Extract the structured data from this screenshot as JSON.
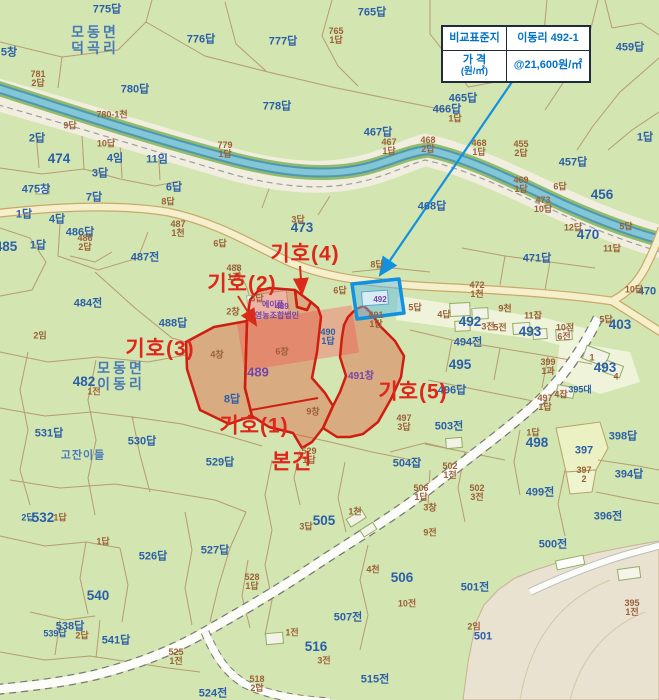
{
  "info_box": {
    "row1_label": "비교표준지",
    "row1_value": "이동리 492-1",
    "row2_label": "가 격",
    "row2_label_sub": "(원/㎡)",
    "row2_value": "@21,600원/㎡"
  },
  "annotations": [
    {
      "t": "기호(4)",
      "x": 305,
      "y": 254
    },
    {
      "t": "기호(2)",
      "x": 242,
      "y": 284
    },
    {
      "t": "기호(3)",
      "x": 160,
      "y": 349
    },
    {
      "t": "기호(1)",
      "x": 254,
      "y": 426
    },
    {
      "t": "기호(5)",
      "x": 413,
      "y": 392
    },
    {
      "t": "본건",
      "x": 292,
      "y": 462
    }
  ],
  "labels": [
    {
      "t": "모동면\n덕곡리",
      "x": 95,
      "y": 40,
      "c": "pl"
    },
    {
      "t": "모동면\n이동리",
      "x": 121,
      "y": 376,
      "c": "pl"
    },
    {
      "t": "고잔이들",
      "x": 83,
      "y": 456,
      "c": "pl",
      "s": "sm"
    },
    {
      "t": "775답",
      "x": 107,
      "y": 10,
      "c": "b"
    },
    {
      "t": "776답",
      "x": 201,
      "y": 40,
      "c": "b"
    },
    {
      "t": "777답",
      "x": 283,
      "y": 42,
      "c": "b"
    },
    {
      "t": "765답",
      "x": 372,
      "y": 13,
      "c": "b"
    },
    {
      "t": "780답",
      "x": 135,
      "y": 90,
      "c": "b"
    },
    {
      "t": "778답",
      "x": 277,
      "y": 107,
      "c": "b"
    },
    {
      "t": "467답",
      "x": 378,
      "y": 133,
      "c": "b"
    },
    {
      "t": "459답",
      "x": 630,
      "y": 48,
      "c": "b"
    },
    {
      "t": "465답",
      "x": 463,
      "y": 99,
      "c": "b"
    },
    {
      "t": "466답",
      "x": 447,
      "y": 110,
      "c": "b"
    },
    {
      "t": "474",
      "x": 59,
      "y": 159,
      "c": "b",
      "s": "lg"
    },
    {
      "t": "2답",
      "x": 37,
      "y": 139,
      "c": "b"
    },
    {
      "t": "4임",
      "x": 115,
      "y": 159,
      "c": "b"
    },
    {
      "t": "11임",
      "x": 157,
      "y": 160,
      "c": "b"
    },
    {
      "t": "3답",
      "x": 100,
      "y": 174,
      "c": "b"
    },
    {
      "t": "5창",
      "x": 9,
      "y": 53,
      "c": "b"
    },
    {
      "t": "475창",
      "x": 36,
      "y": 190,
      "c": "b"
    },
    {
      "t": "6답",
      "x": 174,
      "y": 188,
      "c": "b"
    },
    {
      "t": "7답",
      "x": 94,
      "y": 198,
      "c": "b"
    },
    {
      "t": "1답",
      "x": 24,
      "y": 215,
      "c": "b"
    },
    {
      "t": "4답",
      "x": 57,
      "y": 220,
      "c": "b"
    },
    {
      "t": "486답",
      "x": 80,
      "y": 233,
      "c": "b"
    },
    {
      "t": "485",
      "x": 6,
      "y": 247,
      "c": "b",
      "s": "lg"
    },
    {
      "t": "1답",
      "x": 38,
      "y": 246,
      "c": "b"
    },
    {
      "t": "487전",
      "x": 145,
      "y": 258,
      "c": "b"
    },
    {
      "t": "473",
      "x": 302,
      "y": 228,
      "c": "b",
      "s": "lg"
    },
    {
      "t": "484전",
      "x": 88,
      "y": 304,
      "c": "b"
    },
    {
      "t": "488답",
      "x": 173,
      "y": 324,
      "c": "b"
    },
    {
      "t": "482",
      "x": 84,
      "y": 382,
      "c": "b",
      "s": "lg"
    },
    {
      "t": "531답",
      "x": 49,
      "y": 434,
      "c": "b"
    },
    {
      "t": "530답",
      "x": 142,
      "y": 442,
      "c": "b"
    },
    {
      "t": "529답",
      "x": 220,
      "y": 463,
      "c": "b"
    },
    {
      "t": "8답",
      "x": 232,
      "y": 400,
      "c": "b"
    },
    {
      "t": "527답",
      "x": 215,
      "y": 551,
      "c": "b"
    },
    {
      "t": "526답",
      "x": 153,
      "y": 557,
      "c": "b"
    },
    {
      "t": "532",
      "x": 43,
      "y": 518,
      "c": "b",
      "s": "lg"
    },
    {
      "t": "2답",
      "x": 28,
      "y": 518,
      "c": "b",
      "s": "sm"
    },
    {
      "t": "540",
      "x": 98,
      "y": 596,
      "c": "b",
      "s": "lg"
    },
    {
      "t": "538답",
      "x": 70,
      "y": 627,
      "c": "b"
    },
    {
      "t": "539답",
      "x": 55,
      "y": 634,
      "c": "b",
      "s": "sm"
    },
    {
      "t": "541답",
      "x": 116,
      "y": 641,
      "c": "b"
    },
    {
      "t": "524전",
      "x": 213,
      "y": 694,
      "c": "b"
    },
    {
      "t": "516",
      "x": 316,
      "y": 647,
      "c": "b",
      "s": "lg"
    },
    {
      "t": "515전",
      "x": 375,
      "y": 680,
      "c": "b"
    },
    {
      "t": "507전",
      "x": 348,
      "y": 618,
      "c": "b"
    },
    {
      "t": "505",
      "x": 324,
      "y": 521,
      "c": "b",
      "s": "lg"
    },
    {
      "t": "506",
      "x": 402,
      "y": 578,
      "c": "b",
      "s": "lg"
    },
    {
      "t": "501전",
      "x": 475,
      "y": 588,
      "c": "b"
    },
    {
      "t": "501",
      "x": 483,
      "y": 637,
      "c": "b"
    },
    {
      "t": "500전",
      "x": 553,
      "y": 545,
      "c": "b"
    },
    {
      "t": "499전",
      "x": 540,
      "y": 493,
      "c": "b"
    },
    {
      "t": "396전",
      "x": 608,
      "y": 517,
      "c": "b"
    },
    {
      "t": "398답",
      "x": 623,
      "y": 437,
      "c": "b"
    },
    {
      "t": "394답",
      "x": 629,
      "y": 475,
      "c": "b"
    },
    {
      "t": "397",
      "x": 584,
      "y": 451,
      "c": "b"
    },
    {
      "t": "498",
      "x": 537,
      "y": 443,
      "c": "b",
      "s": "lg"
    },
    {
      "t": "1답",
      "x": 533,
      "y": 433,
      "c": "br"
    },
    {
      "t": "496답",
      "x": 452,
      "y": 391,
      "c": "b"
    },
    {
      "t": "503전",
      "x": 449,
      "y": 427,
      "c": "b"
    },
    {
      "t": "495",
      "x": 460,
      "y": 365,
      "c": "b",
      "s": "lg"
    },
    {
      "t": "494전",
      "x": 468,
      "y": 343,
      "c": "b"
    },
    {
      "t": "492",
      "x": 470,
      "y": 322,
      "c": "b",
      "s": "lg"
    },
    {
      "t": "493",
      "x": 530,
      "y": 332,
      "c": "b",
      "s": "lg"
    },
    {
      "t": "493",
      "x": 605,
      "y": 368,
      "c": "b",
      "s": "lg"
    },
    {
      "t": "403",
      "x": 620,
      "y": 325,
      "c": "b",
      "s": "lg"
    },
    {
      "t": "470",
      "x": 588,
      "y": 235,
      "c": "b",
      "s": "lg"
    },
    {
      "t": "470",
      "x": 647,
      "y": 292,
      "c": "b"
    },
    {
      "t": "471답",
      "x": 537,
      "y": 259,
      "c": "b"
    },
    {
      "t": "456",
      "x": 602,
      "y": 195,
      "c": "b",
      "s": "lg"
    },
    {
      "t": "457답",
      "x": 573,
      "y": 163,
      "c": "b"
    },
    {
      "t": "1답",
      "x": 645,
      "y": 138,
      "c": "b"
    },
    {
      "t": "468답",
      "x": 432,
      "y": 207,
      "c": "b"
    },
    {
      "t": "504잡",
      "x": 407,
      "y": 464,
      "c": "b"
    },
    {
      "t": "490\n1답",
      "x": 328,
      "y": 337,
      "c": "b",
      "s": "sm"
    },
    {
      "t": "395대",
      "x": 580,
      "y": 390,
      "c": "b",
      "s": "sm"
    },
    {
      "t": "765\n1답",
      "x": 336,
      "y": 36,
      "c": "br"
    },
    {
      "t": "781\n2답",
      "x": 38,
      "y": 79,
      "c": "br"
    },
    {
      "t": "780-1천",
      "x": 112,
      "y": 115,
      "c": "br"
    },
    {
      "t": "779\n1답",
      "x": 225,
      "y": 150,
      "c": "br"
    },
    {
      "t": "467\n1답",
      "x": 389,
      "y": 147,
      "c": "br"
    },
    {
      "t": "9답",
      "x": 70,
      "y": 126,
      "c": "br"
    },
    {
      "t": "10답",
      "x": 106,
      "y": 144,
      "c": "br"
    },
    {
      "t": "8답",
      "x": 168,
      "y": 202,
      "c": "br"
    },
    {
      "t": "486\n2답",
      "x": 85,
      "y": 243,
      "c": "br"
    },
    {
      "t": "487\n1천",
      "x": 178,
      "y": 229,
      "c": "br"
    },
    {
      "t": "2임",
      "x": 40,
      "y": 336,
      "c": "br"
    },
    {
      "t": "1전",
      "x": 94,
      "y": 392,
      "c": "br"
    },
    {
      "t": "468\n2답",
      "x": 428,
      "y": 145,
      "c": "br"
    },
    {
      "t": "468\n1답",
      "x": 479,
      "y": 148,
      "c": "br"
    },
    {
      "t": "455\n2답",
      "x": 521,
      "y": 149,
      "c": "br"
    },
    {
      "t": "469\n1답",
      "x": 521,
      "y": 185,
      "c": "br"
    },
    {
      "t": "6답",
      "x": 560,
      "y": 187,
      "c": "br"
    },
    {
      "t": "473\n10답",
      "x": 543,
      "y": 205,
      "c": "br"
    },
    {
      "t": "12답",
      "x": 573,
      "y": 228,
      "c": "br"
    },
    {
      "t": "5답",
      "x": 626,
      "y": 227,
      "c": "br"
    },
    {
      "t": "11답",
      "x": 612,
      "y": 249,
      "c": "br"
    },
    {
      "t": "10답",
      "x": 634,
      "y": 290,
      "c": "br"
    },
    {
      "t": "3답",
      "x": 298,
      "y": 220,
      "c": "br"
    },
    {
      "t": "6답",
      "x": 220,
      "y": 244,
      "c": "br"
    },
    {
      "t": "488\n1전",
      "x": 234,
      "y": 273,
      "c": "br"
    },
    {
      "t": "8답",
      "x": 377,
      "y": 265,
      "c": "br"
    },
    {
      "t": "6답",
      "x": 340,
      "y": 291,
      "c": "br"
    },
    {
      "t": "3답",
      "x": 257,
      "y": 299,
      "c": "br"
    },
    {
      "t": "5답",
      "x": 415,
      "y": 308,
      "c": "br"
    },
    {
      "t": "4답",
      "x": 444,
      "y": 315,
      "c": "br"
    },
    {
      "t": "472\n1천",
      "x": 477,
      "y": 290,
      "c": "br"
    },
    {
      "t": "9천",
      "x": 505,
      "y": 309,
      "c": "br"
    },
    {
      "t": "3전",
      "x": 488,
      "y": 327,
      "c": "br"
    },
    {
      "t": "5전",
      "x": 500,
      "y": 328,
      "c": "br"
    },
    {
      "t": "11잡",
      "x": 533,
      "y": 316,
      "c": "br"
    },
    {
      "t": "10전",
      "x": 565,
      "y": 328,
      "c": "br"
    },
    {
      "t": "6전",
      "x": 564,
      "y": 337,
      "c": "br"
    },
    {
      "t": "399\n1과",
      "x": 548,
      "y": 367,
      "c": "br"
    },
    {
      "t": "4잡",
      "x": 561,
      "y": 395,
      "c": "br"
    },
    {
      "t": "1",
      "x": 592,
      "y": 358,
      "c": "br"
    },
    {
      "t": "4",
      "x": 616,
      "y": 377,
      "c": "br"
    },
    {
      "t": "5답",
      "x": 606,
      "y": 320,
      "c": "br"
    },
    {
      "t": "491\n1답",
      "x": 376,
      "y": 320,
      "c": "br"
    },
    {
      "t": "497\n1답",
      "x": 545,
      "y": 403,
      "c": "br"
    },
    {
      "t": "497\n3답",
      "x": 404,
      "y": 423,
      "c": "br"
    },
    {
      "t": "529\n1답",
      "x": 309,
      "y": 456,
      "c": "br"
    },
    {
      "t": "3답",
      "x": 306,
      "y": 527,
      "c": "br"
    },
    {
      "t": "1천",
      "x": 355,
      "y": 512,
      "c": "br"
    },
    {
      "t": "1전",
      "x": 292,
      "y": 633,
      "c": "br"
    },
    {
      "t": "3전",
      "x": 324,
      "y": 661,
      "c": "br"
    },
    {
      "t": "10전",
      "x": 407,
      "y": 604,
      "c": "br"
    },
    {
      "t": "2임",
      "x": 474,
      "y": 627,
      "c": "br"
    },
    {
      "t": "395\n1전",
      "x": 632,
      "y": 608,
      "c": "br"
    },
    {
      "t": "506\n1답",
      "x": 421,
      "y": 493,
      "c": "br"
    },
    {
      "t": "502\n3전",
      "x": 477,
      "y": 493,
      "c": "br"
    },
    {
      "t": "502\n1전",
      "x": 450,
      "y": 471,
      "c": "br"
    },
    {
      "t": "397\n2",
      "x": 584,
      "y": 475,
      "c": "br"
    },
    {
      "t": "3창",
      "x": 430,
      "y": 508,
      "c": "br"
    },
    {
      "t": "9전",
      "x": 430,
      "y": 533,
      "c": "br"
    },
    {
      "t": "4천",
      "x": 373,
      "y": 570,
      "c": "br"
    },
    {
      "t": "1답",
      "x": 60,
      "y": 518,
      "c": "br"
    },
    {
      "t": "1답",
      "x": 103,
      "y": 542,
      "c": "br"
    },
    {
      "t": "528\n1답",
      "x": 252,
      "y": 582,
      "c": "br"
    },
    {
      "t": "2답",
      "x": 82,
      "y": 636,
      "c": "br"
    },
    {
      "t": "525\n1전",
      "x": 176,
      "y": 657,
      "c": "br"
    },
    {
      "t": "518\n2답",
      "x": 257,
      "y": 684,
      "c": "br"
    },
    {
      "t": "2창",
      "x": 233,
      "y": 312,
      "c": "br"
    },
    {
      "t": "4창",
      "x": 217,
      "y": 355,
      "c": "br"
    },
    {
      "t": "6창",
      "x": 282,
      "y": 352,
      "c": "br"
    },
    {
      "t": "9창",
      "x": 313,
      "y": 412,
      "c": "br"
    },
    {
      "t": "1답",
      "x": 455,
      "y": 119,
      "c": "br"
    },
    {
      "t": "에이플",
      "x": 273,
      "y": 305,
      "c": "p",
      "s": "sm"
    },
    {
      "t": "영농조합법인",
      "x": 277,
      "y": 316,
      "c": "p",
      "s": "sm"
    },
    {
      "t": "489",
      "x": 282,
      "y": 307,
      "c": "p",
      "s": "sm"
    },
    {
      "t": "489",
      "x": 258,
      "y": 372,
      "c": "p",
      "s": "lg"
    },
    {
      "t": "491창",
      "x": 361,
      "y": 377,
      "c": "p"
    },
    {
      "t": "492",
      "x": 380,
      "y": 300,
      "c": "p",
      "s": "sm"
    }
  ],
  "colors": {
    "background_green": "#d3e5b0",
    "boundary_brown": "#b18e66",
    "water_teal": "#5a9fb5",
    "road_yellow": "#f6efcb",
    "highlight_red": "#cf1d12",
    "highlight_blue": "#1191e0",
    "label_blue": "#2b5fa8",
    "label_brown": "#9b6038",
    "label_purple": "#7743a8",
    "info_text_blue": "#0072c6",
    "mountain_beige": "#e9e2d1"
  }
}
